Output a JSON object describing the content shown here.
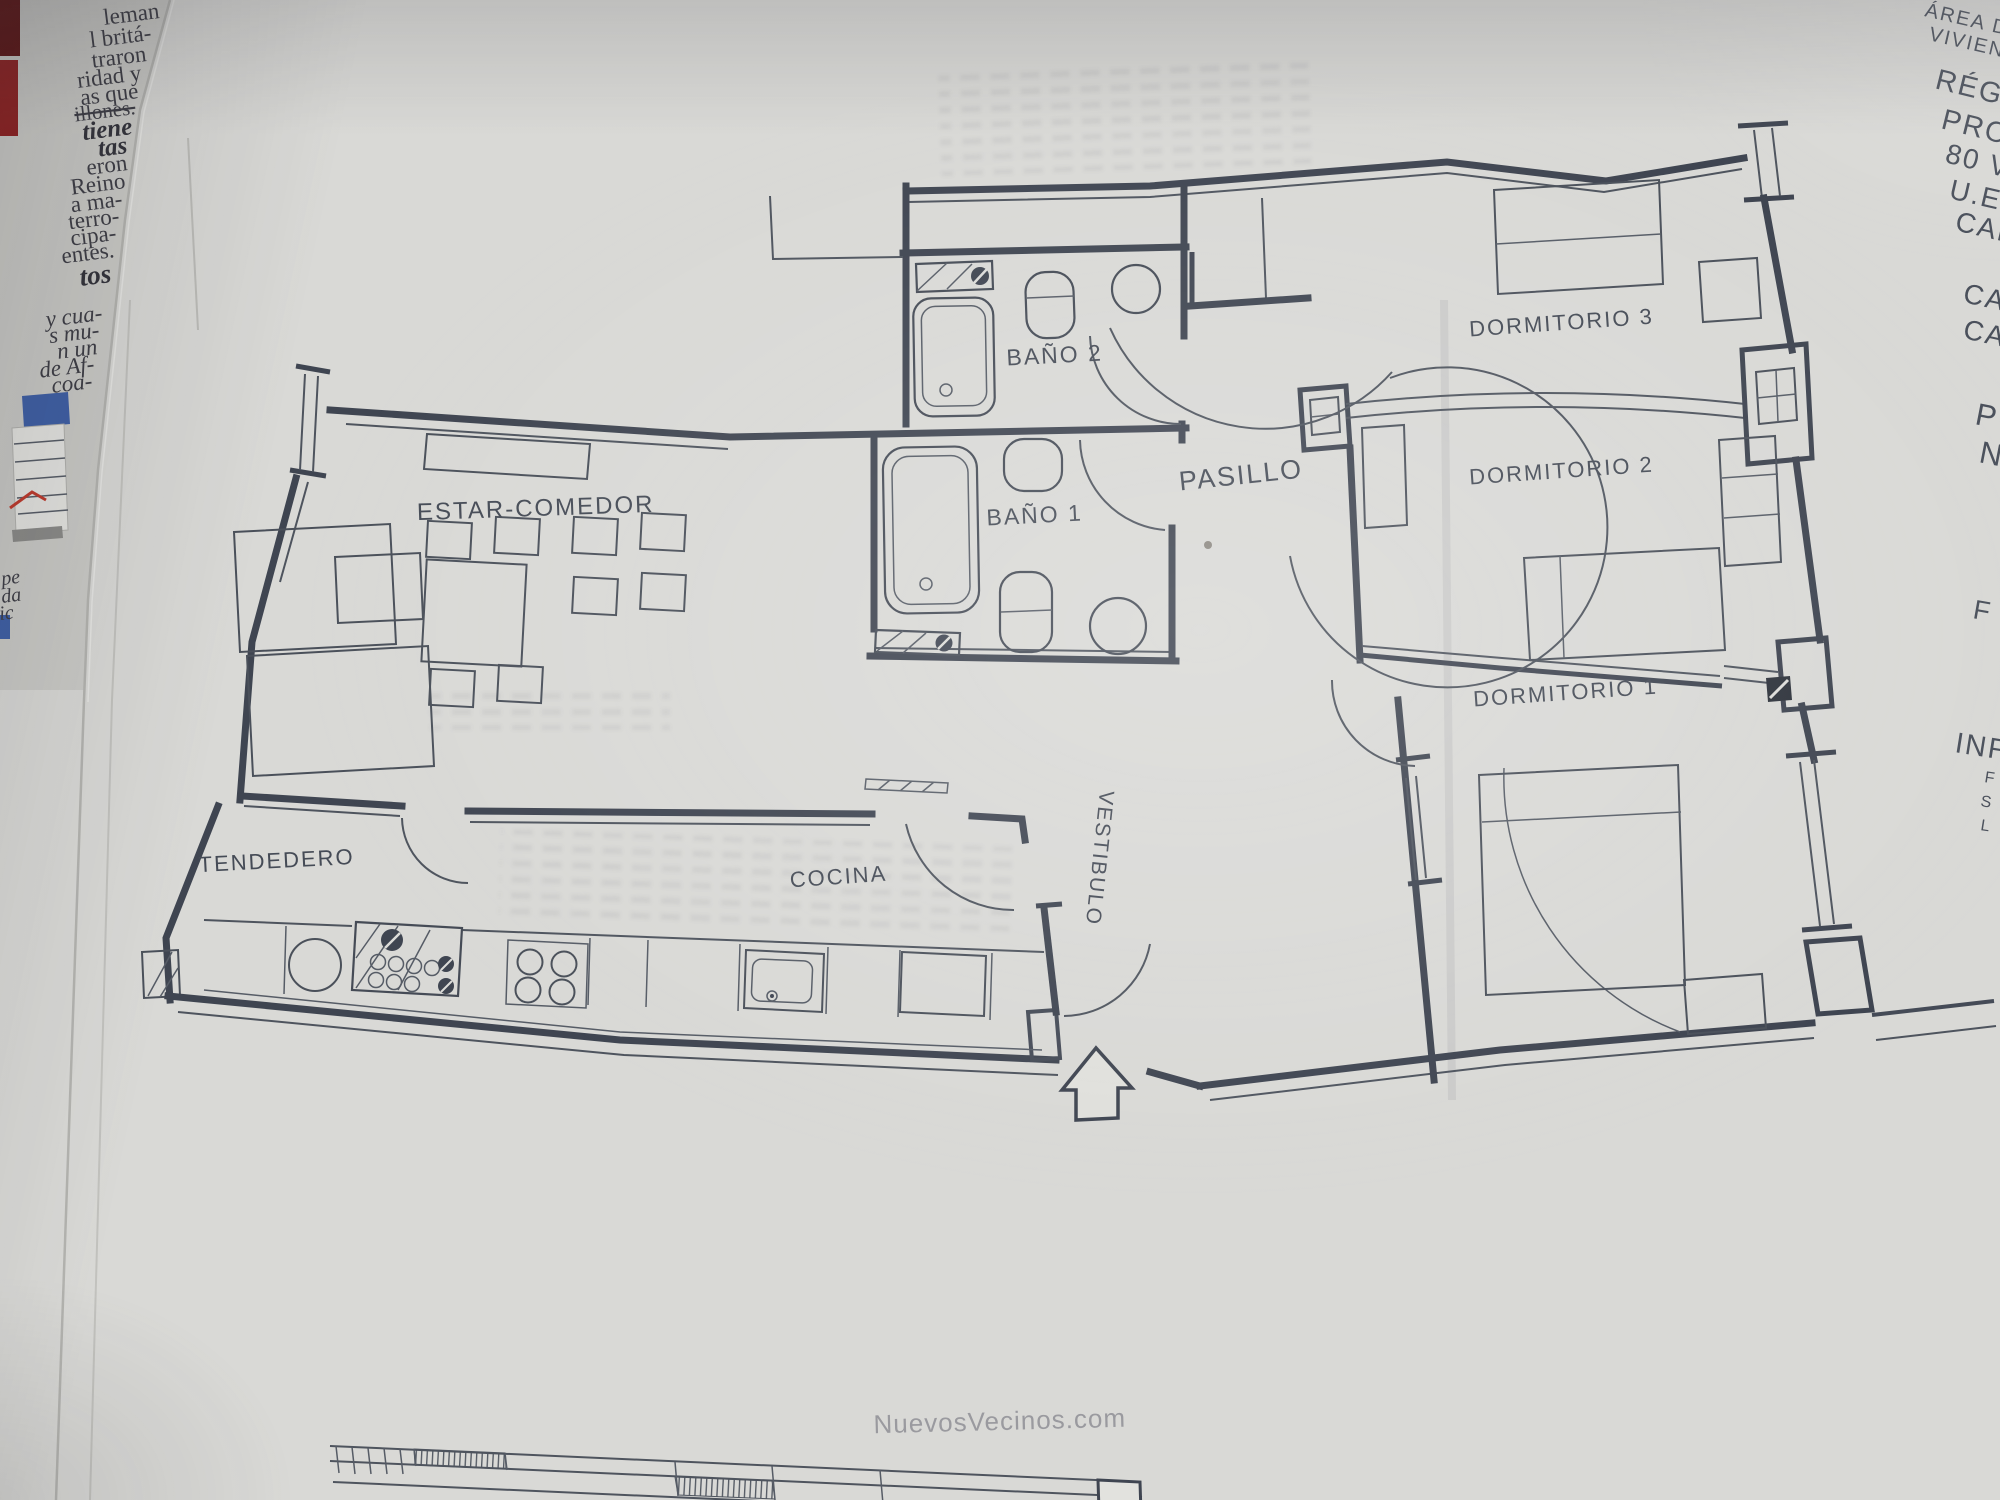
{
  "photo": {
    "watermark": "NuevosVecinos.com"
  },
  "floor_plan": {
    "rooms": [
      {
        "id": "estar",
        "label": "ESTAR-COMEDOR"
      },
      {
        "id": "bano2",
        "label": "BAÑO 2"
      },
      {
        "id": "bano1",
        "label": "BAÑO 1"
      },
      {
        "id": "pasillo",
        "label": "PASILLO"
      },
      {
        "id": "dorm3",
        "label": "DORMITORIO 3"
      },
      {
        "id": "dorm2",
        "label": "DORMITORIO 2"
      },
      {
        "id": "dorm1",
        "label": "DORMITORIO 1"
      },
      {
        "id": "tendedero",
        "label": "TENDEDERO"
      },
      {
        "id": "cocina",
        "label": "COCINA"
      },
      {
        "id": "vestibulo",
        "label": "VESTIBULO"
      }
    ]
  },
  "margin_text": {
    "items": [
      {
        "text": "ÁREA D"
      },
      {
        "text": "VIVIEND"
      },
      {
        "text": "RÉGI"
      },
      {
        "text": "PRO"
      },
      {
        "text": "80 V"
      },
      {
        "text": "U.E"
      },
      {
        "text": "CAL"
      },
      {
        "text": "CA"
      },
      {
        "text": "CA"
      },
      {
        "text": "P"
      },
      {
        "text": "N"
      },
      {
        "text": "F"
      },
      {
        "text": "INF"
      },
      {
        "text": "F"
      },
      {
        "text": "S"
      },
      {
        "text": "L"
      }
    ]
  },
  "newspaper": {
    "fragments": [
      {
        "text": "leman"
      },
      {
        "text": "l britá-"
      },
      {
        "text": "traron"
      },
      {
        "text": "ridad y"
      },
      {
        "text": "as que"
      },
      {
        "text": "illones."
      },
      {
        "text": "tiene"
      },
      {
        "text": "tas"
      },
      {
        "text": "eron"
      },
      {
        "text": "Reino"
      },
      {
        "text": "a ma-"
      },
      {
        "text": "terro-"
      },
      {
        "text": "cipa-"
      },
      {
        "text": "entes."
      },
      {
        "text": "tos"
      },
      {
        "text": "y cua-"
      },
      {
        "text": "s mu-"
      },
      {
        "text": "n un"
      },
      {
        "text": "de Af-"
      },
      {
        "text": "coa-"
      },
      {
        "text": "pe"
      },
      {
        "text": "da"
      },
      {
        "text": "ic"
      }
    ]
  },
  "colors": {
    "ink": "#3f4551",
    "paper": "#d9d9d6",
    "newsprint": "#cbcbc7",
    "accent_blue": "#3e5fa6",
    "accent_red": "#8e2020",
    "watermark_gray": "#94949a"
  }
}
